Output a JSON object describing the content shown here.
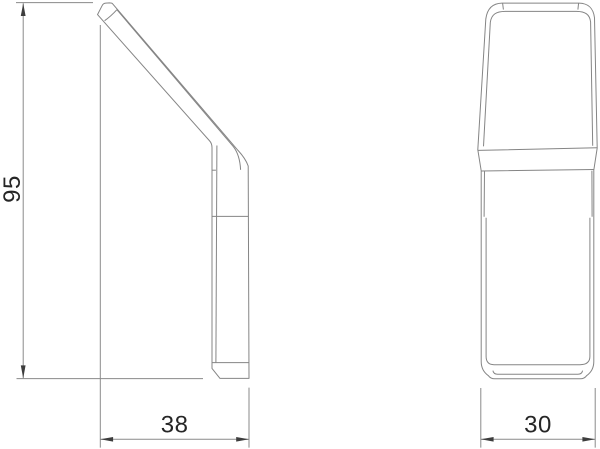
{
  "drawing": {
    "type": "technical-orthographic-drawing",
    "views": [
      {
        "id": "side-view"
      },
      {
        "id": "front-view"
      }
    ],
    "dimensions": {
      "height": {
        "label": "95",
        "orientation": "vertical",
        "view": "side-view"
      },
      "depth": {
        "label": "38",
        "orientation": "horizontal",
        "view": "side-view"
      },
      "width": {
        "label": "30",
        "orientation": "horizontal",
        "view": "front-view"
      }
    },
    "colors": {
      "line": "#858585",
      "dimension_line": "#8a8a8a",
      "arrow": "#3d3d3d",
      "text": "#262626",
      "background": "#ffffff"
    }
  }
}
